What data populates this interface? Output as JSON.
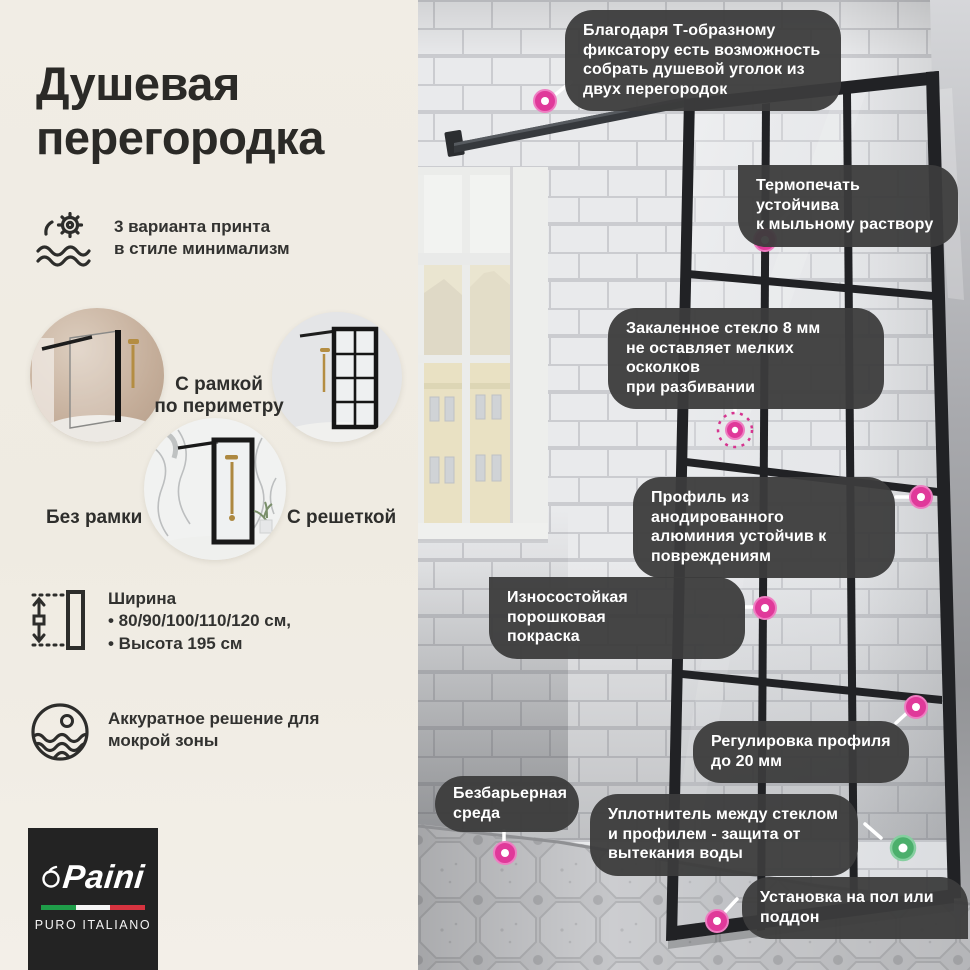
{
  "colors": {
    "panel_bg": "#EFEBE2",
    "callout_bg": "#3C3C3C",
    "accent_pink": "#E0399A",
    "accent_green": "#4CAF6C",
    "flag_green": "#1F9D49",
    "flag_red": "#D6333F",
    "title_color": "#2B2A27"
  },
  "left_panel": {
    "title": "Душевая\nперегородка",
    "features": [
      {
        "icon": "print-icon",
        "text": "3 варианта принта\nв стиле минимализм"
      },
      {
        "icon": "width-icon",
        "text": "Ширина\n• 80/90/100/110/120 см,\n• Высота 195 см"
      },
      {
        "icon": "wet-zone-icon",
        "text": "Аккуратное решение для\nмокрой зоны"
      }
    ],
    "variants": [
      {
        "label": "Без рамки"
      },
      {
        "label": "С рамкой\nпо периметру"
      },
      {
        "label": "С решеткой"
      }
    ],
    "logo": {
      "brand": "Paini",
      "tagline": "PURO ITALIANO"
    }
  },
  "callouts": [
    {
      "text": "Благодаря Т-образному\nфиксатору есть возможность\nсобрать душевой уголок из\nдвух перегородок",
      "marker": "pink"
    },
    {
      "text": "Термопечать устойчива\nк мыльному раствору",
      "marker": "pink"
    },
    {
      "text": "Закаленное стекло 8 мм\nне оставляет мелких осколков\nпри разбивании",
      "marker": "pink"
    },
    {
      "text": "Профиль из анодированного\nалюминия устойчив к\nповреждениям",
      "marker": "pink"
    },
    {
      "text": "Износостойкая порошковая\nпокраска",
      "marker": "pink"
    },
    {
      "text": "Регулировка профиля\nдо 20 мм",
      "marker": "pink"
    },
    {
      "text": "Безбарьерная\nсреда",
      "marker": "pink"
    },
    {
      "text": "Уплотнитель между стеклом\nи профилем - защита от\nвытекания воды",
      "marker": "green"
    },
    {
      "text": "Установка на пол или\nподдон",
      "marker": "pink"
    }
  ]
}
